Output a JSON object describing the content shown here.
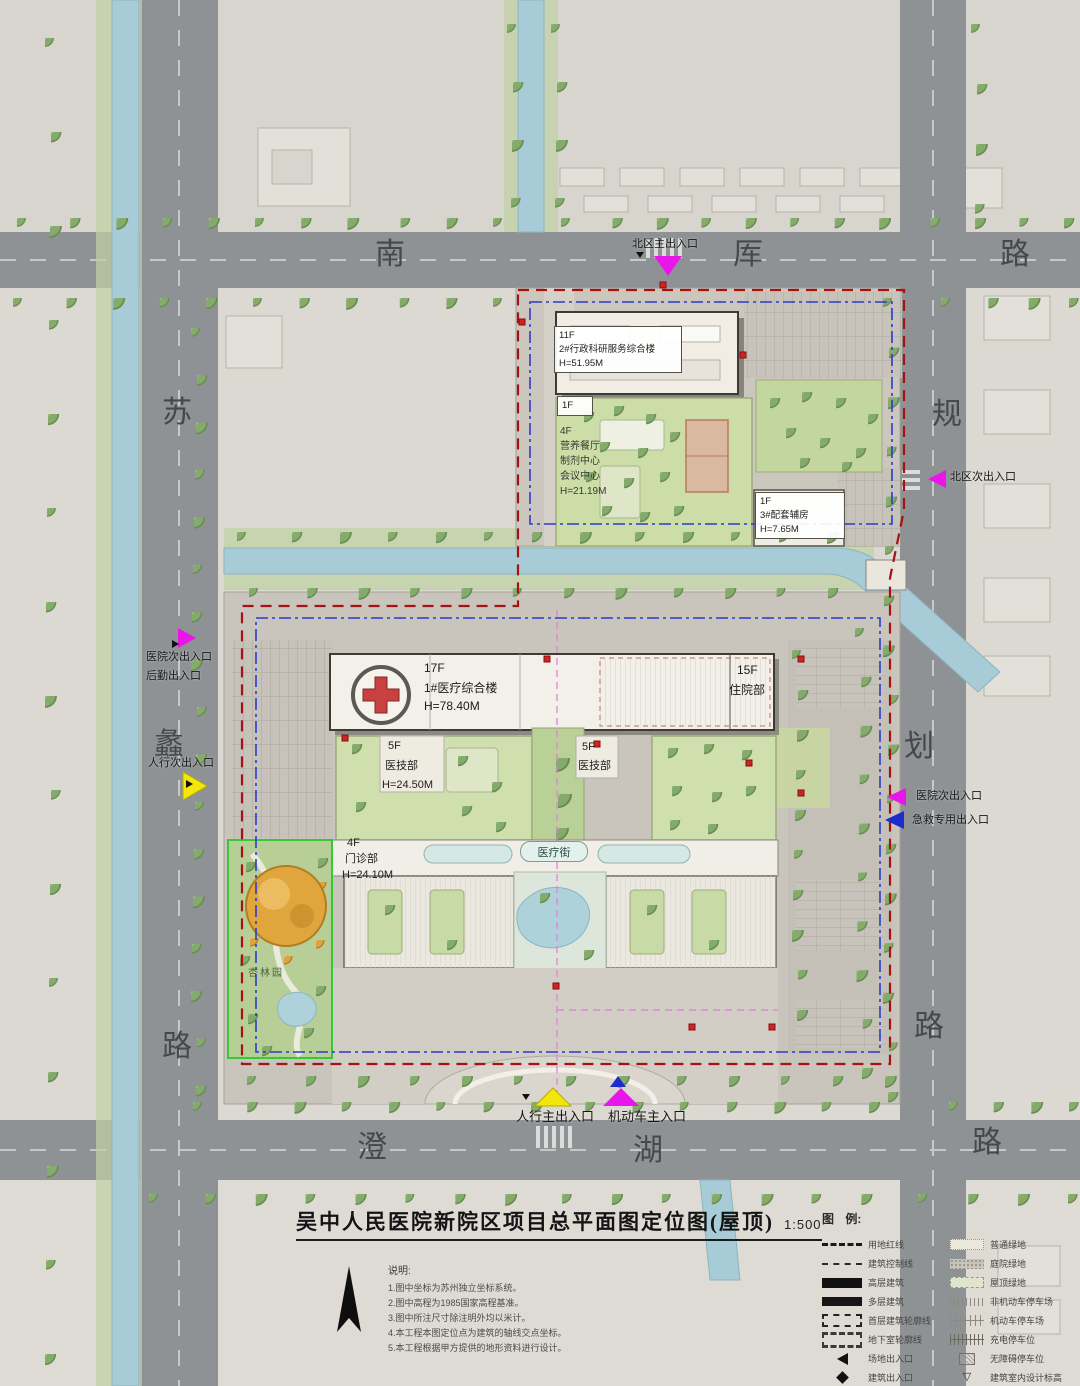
{
  "header": {
    "title": "吴中人民医院新院区项目总平面图定位图(屋顶)",
    "scale": "1:500"
  },
  "roads": {
    "north": [
      "南",
      "厍",
      "路"
    ],
    "south": [
      "澄",
      "湖",
      "路"
    ],
    "west": [
      "苏",
      "蠡",
      "路"
    ],
    "east": [
      "规",
      "划",
      "路"
    ]
  },
  "entrances": {
    "north_main": "北区主出入口",
    "north_secondary": "北区次出入口",
    "west_hospital": "医院次出入口",
    "west_logistics": "后勤出入口",
    "west_pedestrian": "人行次出入口",
    "east_hospital": "医院次出入口",
    "east_emergency": "急救专用出入口",
    "south_pedestrian": "人行主出入口",
    "south_vehicle": "机动车主入口"
  },
  "buildings": {
    "admin": {
      "floors": "11F",
      "name": "2#行政科研服务综合楼",
      "height": "H=51.95M"
    },
    "admin_podium": {
      "floors": "1F"
    },
    "annex": {
      "floors": "4F",
      "line1": "营养餐厅",
      "line2": "制剂中心",
      "line3": "会议中心",
      "height": "H=21.19M"
    },
    "support": {
      "floors": "1F",
      "name": "3#配套辅房",
      "height": "H=7.65M"
    },
    "medical_main": {
      "floors": "17F",
      "name": "1#医疗综合楼",
      "height": "H=78.40M"
    },
    "inpatient": {
      "floors": "15F",
      "name": "住院部"
    },
    "medtech_west": {
      "floors": "5F",
      "name": "医技部",
      "height": "H=24.50M"
    },
    "medtech_east": {
      "floors": "5F",
      "name": "医技部"
    },
    "outpatient": {
      "floors": "4F",
      "name": "门诊部",
      "height": "H=24.10M"
    },
    "street": "医疗街",
    "garden": "杏林园"
  },
  "legend": {
    "header": "图 例:",
    "left": [
      {
        "label": "用地红线"
      },
      {
        "label": "建筑控制线"
      },
      {
        "label": "高层建筑"
      },
      {
        "label": "多层建筑"
      },
      {
        "label": "首层建筑轮廓线"
      },
      {
        "label": "地下室轮廓线"
      },
      {
        "label": "场地出入口"
      },
      {
        "label": "建筑出入口"
      },
      {
        "label": "消防登高扑救场地"
      }
    ],
    "right": [
      {
        "label": "普通绿地"
      },
      {
        "label": "庭院绿地"
      },
      {
        "label": "屋顶绿地"
      },
      {
        "label": "非机动车停车场"
      },
      {
        "label": "机动车停车场"
      },
      {
        "label": "充电停车位"
      },
      {
        "label": "无障碍停车位"
      },
      {
        "label": "建筑室内设计标高"
      }
    ]
  },
  "notes": {
    "header": "说明:",
    "lines": [
      "1.图中坐标为苏州独立坐标系统。",
      "2.图中高程为1985国家高程基准。",
      "3.图中所注尺寸除注明外均以米计。",
      "4.本工程本图定位点为建筑的轴线交点坐标。",
      "5.本工程根据甲方提供的地形资料进行设计。"
    ]
  },
  "colors": {
    "magenta": "#e816e8",
    "yellow": "#f2e60a",
    "blue": "#1f2ccc",
    "red_line": "#a51212",
    "blue_line": "#2b3cc8",
    "water": "#a7cbd7",
    "road": "#8f9295"
  }
}
